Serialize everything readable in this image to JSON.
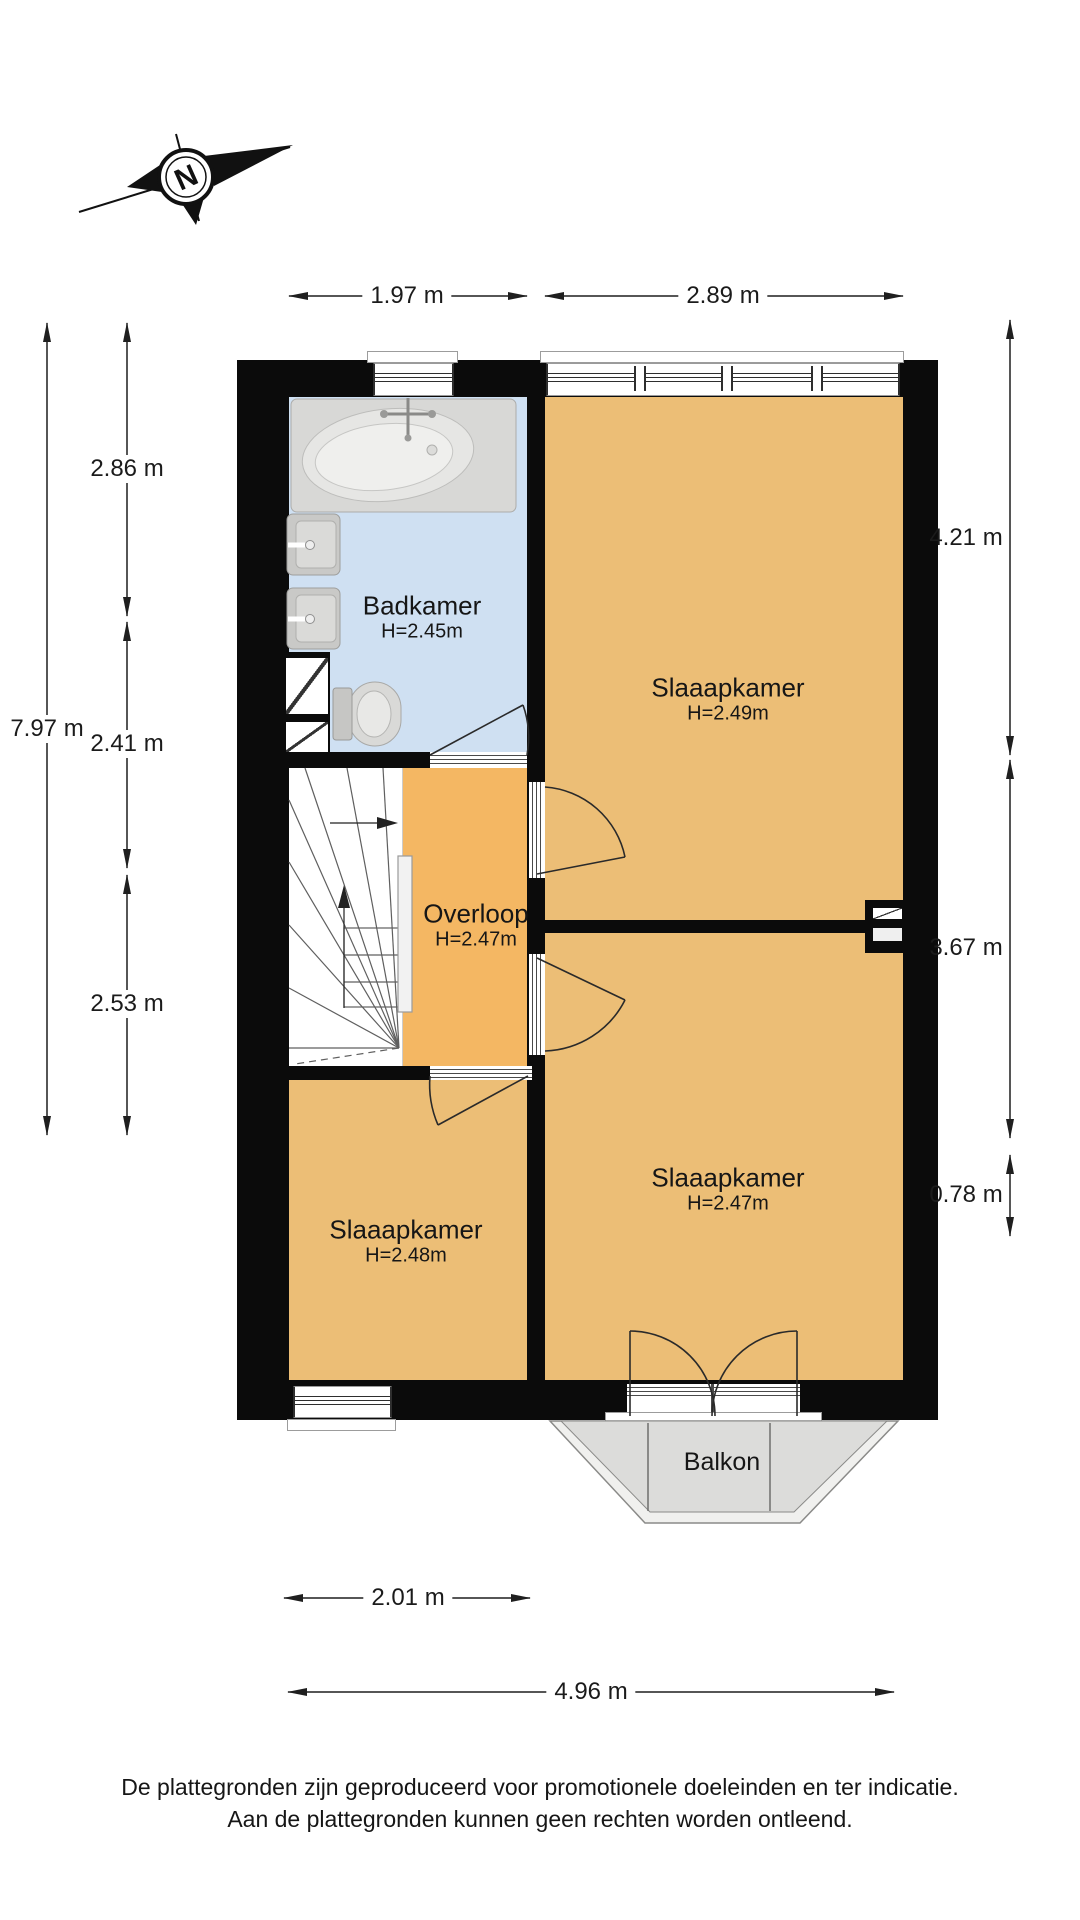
{
  "compass": {
    "label": "N"
  },
  "rooms": [
    {
      "id": "badkamer",
      "name": "Badkamer",
      "height": "H=2.45m"
    },
    {
      "id": "slaapkamer-boven",
      "name": "Slaaapkamer",
      "height": "H=2.49m"
    },
    {
      "id": "overloop",
      "name": "Overloop",
      "height": "H=2.47m"
    },
    {
      "id": "slaapkamer-rechts",
      "name": "Slaaapkamer",
      "height": "H=2.47m"
    },
    {
      "id": "slaapkamer-links",
      "name": "Slaaapkamer",
      "height": "H=2.48m"
    },
    {
      "id": "balkon",
      "name": "Balkon"
    }
  ],
  "dimensions": {
    "top": [
      "1.97 m",
      "2.89 m"
    ],
    "left_total": "7.97 m",
    "left": [
      "2.86 m",
      "2.41 m",
      "2.53 m"
    ],
    "right": [
      "4.21 m",
      "3.67 m",
      "0.78 m"
    ],
    "bottom": [
      "2.01 m",
      "4.96 m"
    ]
  },
  "footer": {
    "line1": "De plattegronden zijn geproduceerd voor promotionele doeleinden en ter indicatie.",
    "line2": "Aan de plattegronden kunnen geen rechten worden ontleend."
  },
  "colors": {
    "wall": "#0b0b0b",
    "bedroom_floor": "#ecbe76",
    "hall_floor": "#f4b763",
    "bathroom_floor": "#cfe0f2",
    "balcony_floor": "#dcdcda"
  }
}
